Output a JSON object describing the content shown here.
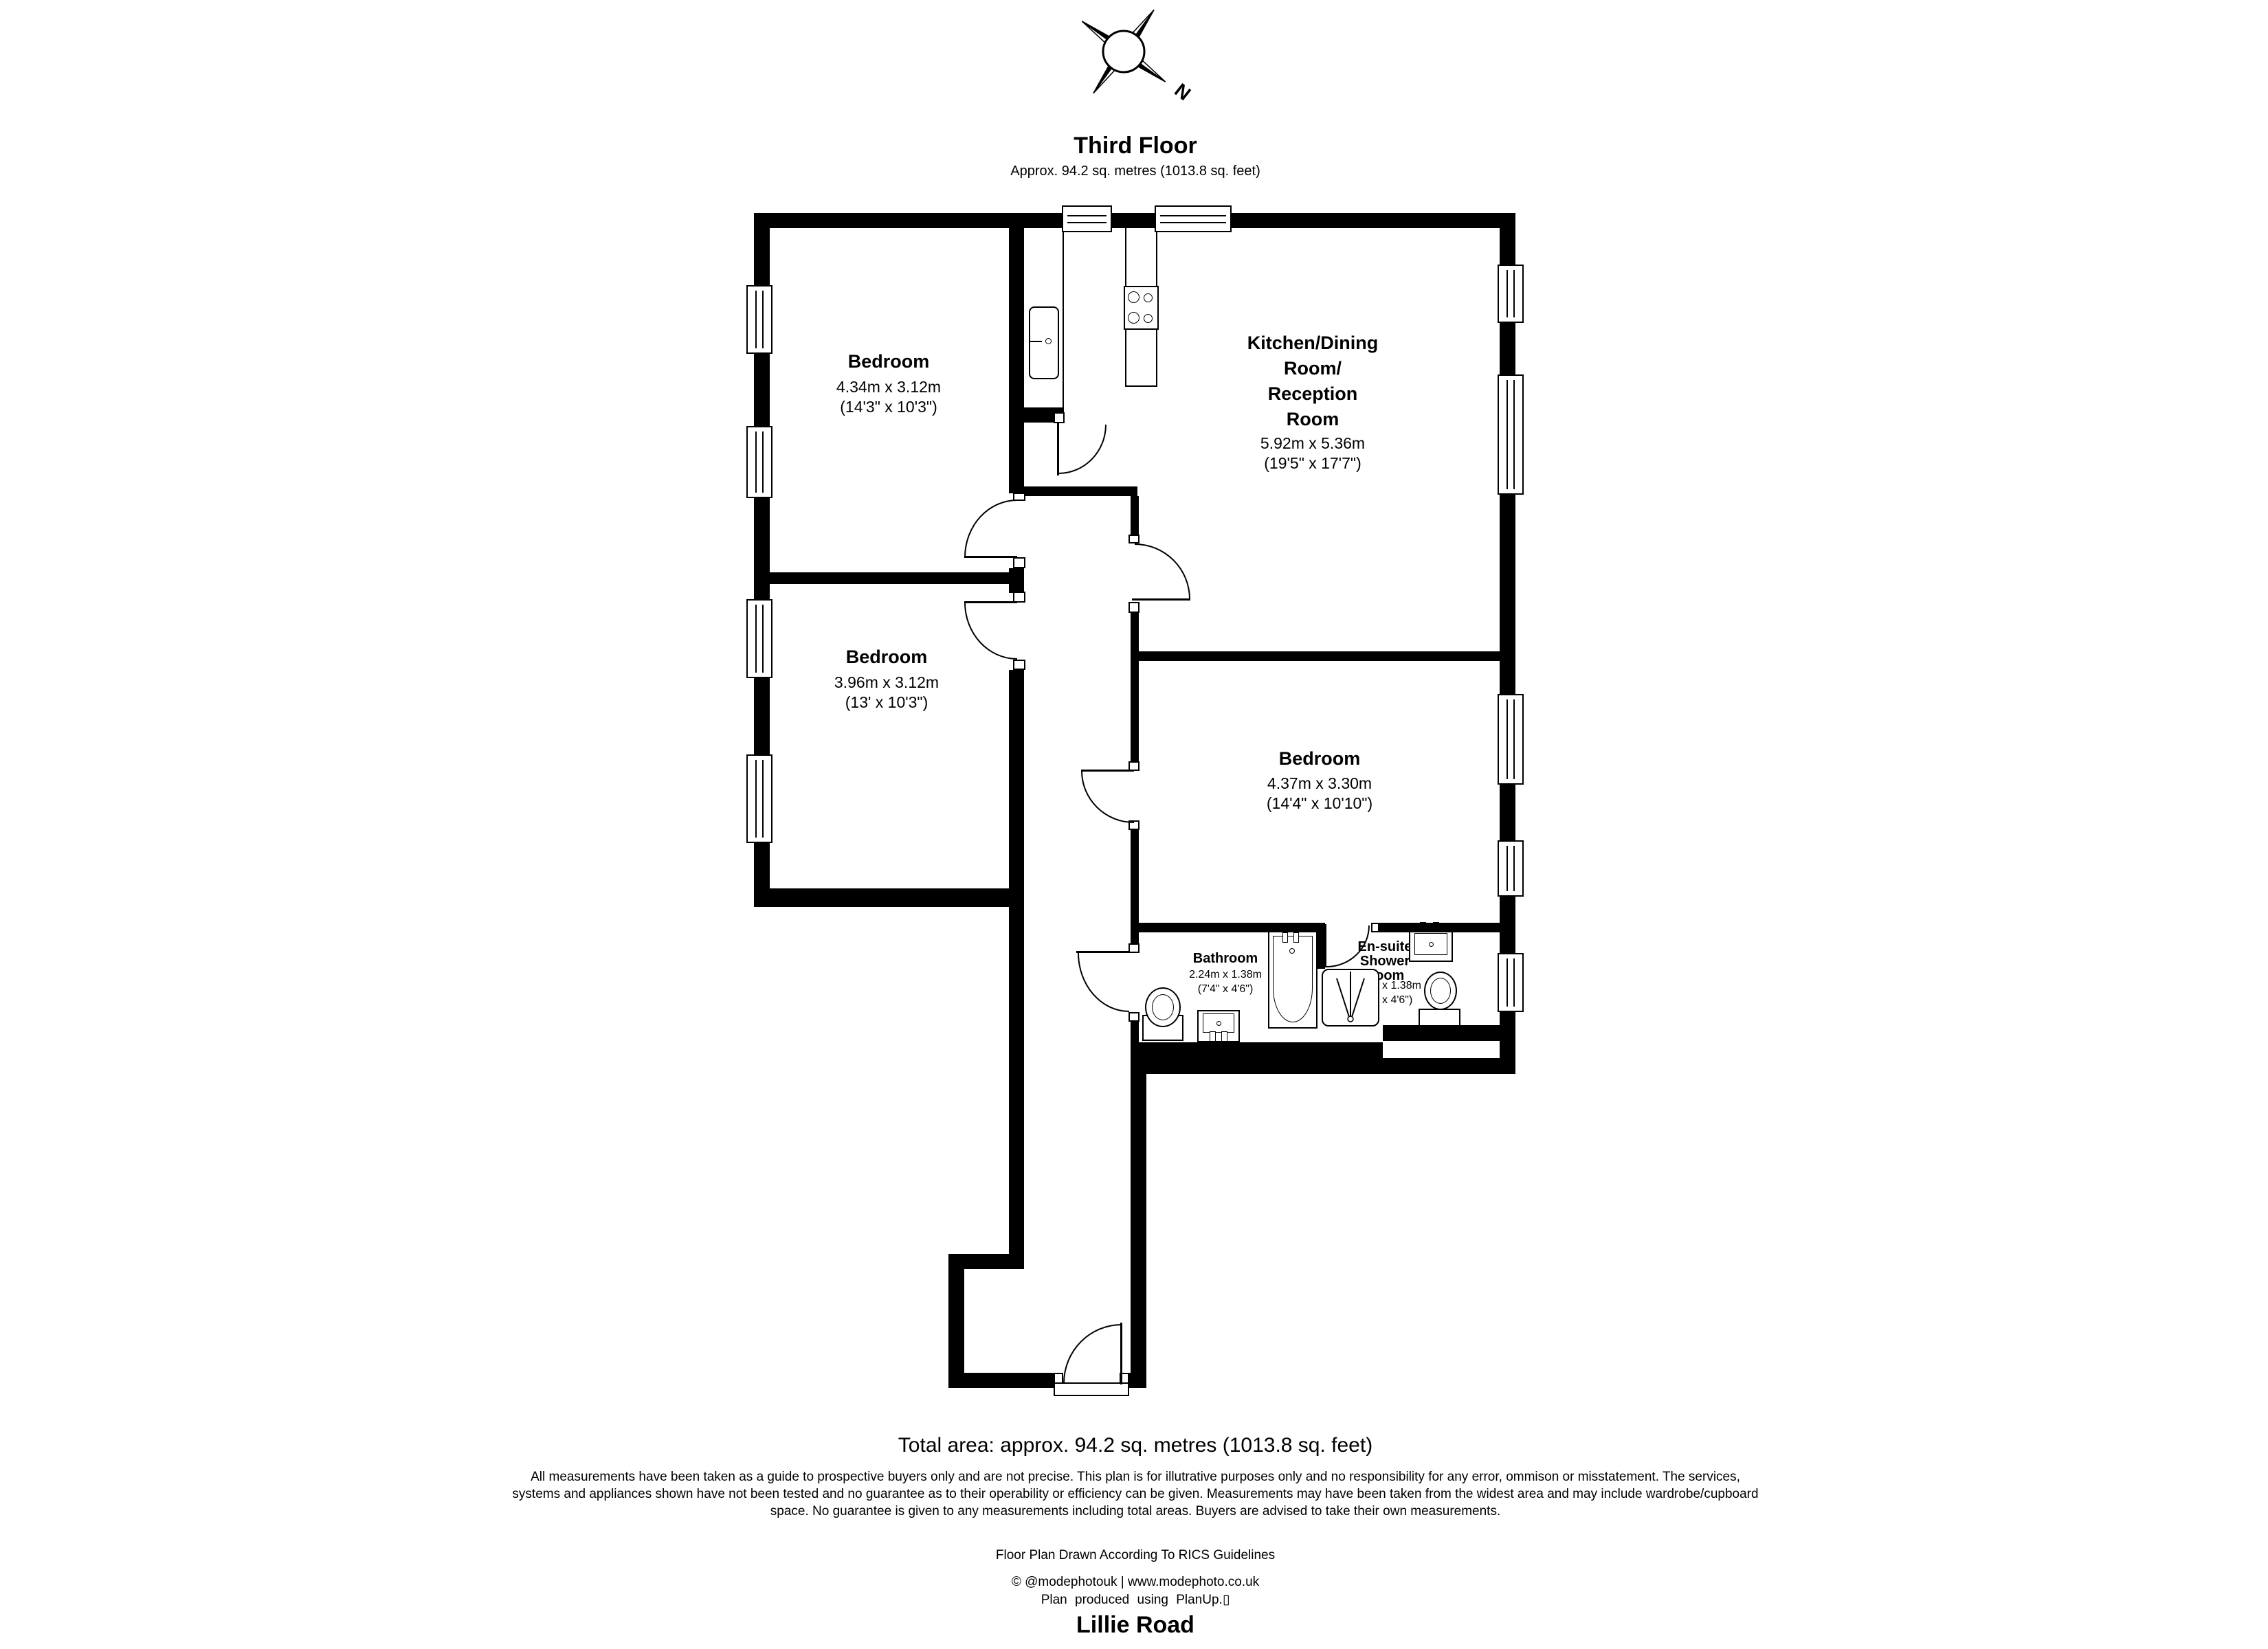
{
  "header": {
    "floor_title": "Third Floor",
    "floor_area": "Approx. 94.2 sq. metres (1013.8 sq. feet)"
  },
  "compass": {
    "north_label": "N"
  },
  "rooms": {
    "bedroom_top_left": {
      "name": "Bedroom",
      "dim_metric": "4.34m x 3.12m",
      "dim_imperial": "(14'3\" x 10'3\")"
    },
    "bedroom_mid_left": {
      "name": "Bedroom",
      "dim_metric": "3.96m x 3.12m",
      "dim_imperial": "(13' x 10'3\")"
    },
    "kitchen_reception": {
      "name_line1": "Kitchen/Dining",
      "name_line2": "Room/",
      "name_line3": "Reception",
      "name_line4": "Room",
      "dim_metric": "5.92m x 5.36m",
      "dim_imperial": "(19'5\" x 17'7\")"
    },
    "bedroom_right": {
      "name": "Bedroom",
      "dim_metric": "4.37m x 3.30m",
      "dim_imperial": "(14'4\" x 10'10\")"
    },
    "bathroom": {
      "name": "Bathroom",
      "dim_metric": "2.24m x 1.38m",
      "dim_imperial": "(7'4\" x 4'6\")"
    },
    "ensuite": {
      "name_line1": "En-suite",
      "name_line2": "Shower",
      "name_line3": "Room",
      "dim_metric": "2.21m x 1.38m",
      "dim_imperial": "(7'3\" x 4'6\")"
    }
  },
  "footer": {
    "total_area": "Total area: approx. 94.2 sq. metres (1013.8 sq. feet)",
    "disclaimer_line1": "All measurements have been taken as a guide to prospective buyers only and are not precise. This plan is for illutrative purposes only and no responsibility for any error, ommison or misstatement. The services,",
    "disclaimer_line2": "systems and appliances shown have not been tested and no guarantee as to their operability or efficiency can be given. Measurements may have been taken from the widest area and may include wardrobe/cupboard",
    "disclaimer_line3": "space. No guarantee is given to any measurements including total areas. Buyers are advised to take their own measurements.",
    "rics_line": "Floor Plan Drawn According To RICS Guidelines",
    "credit_line": "© @modephotouk | www.modephoto.co.uk",
    "produced_line": "Plan produced using PlanUp.▯",
    "address": "Lillie Road"
  },
  "colors": {
    "line": "#000000",
    "background": "#ffffff"
  }
}
